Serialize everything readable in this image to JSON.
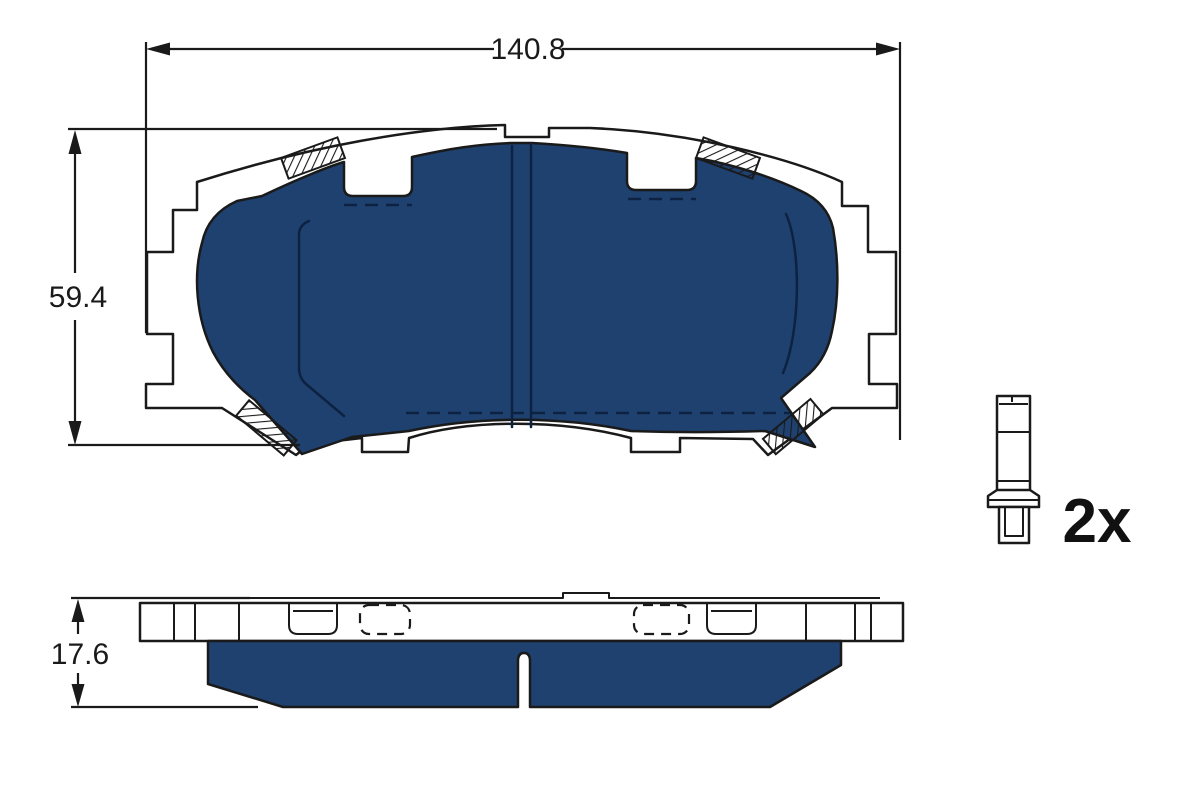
{
  "drawing": {
    "subject": "brake-pad-set-technical-drawing",
    "dimensions": {
      "width": "140.8",
      "height": "59.4",
      "thickness": "17.6"
    },
    "accessory_quantity": "2x",
    "colors": {
      "friction_material": "#1e4170",
      "line": "#1a1a1a",
      "background": "#ffffff"
    }
  }
}
